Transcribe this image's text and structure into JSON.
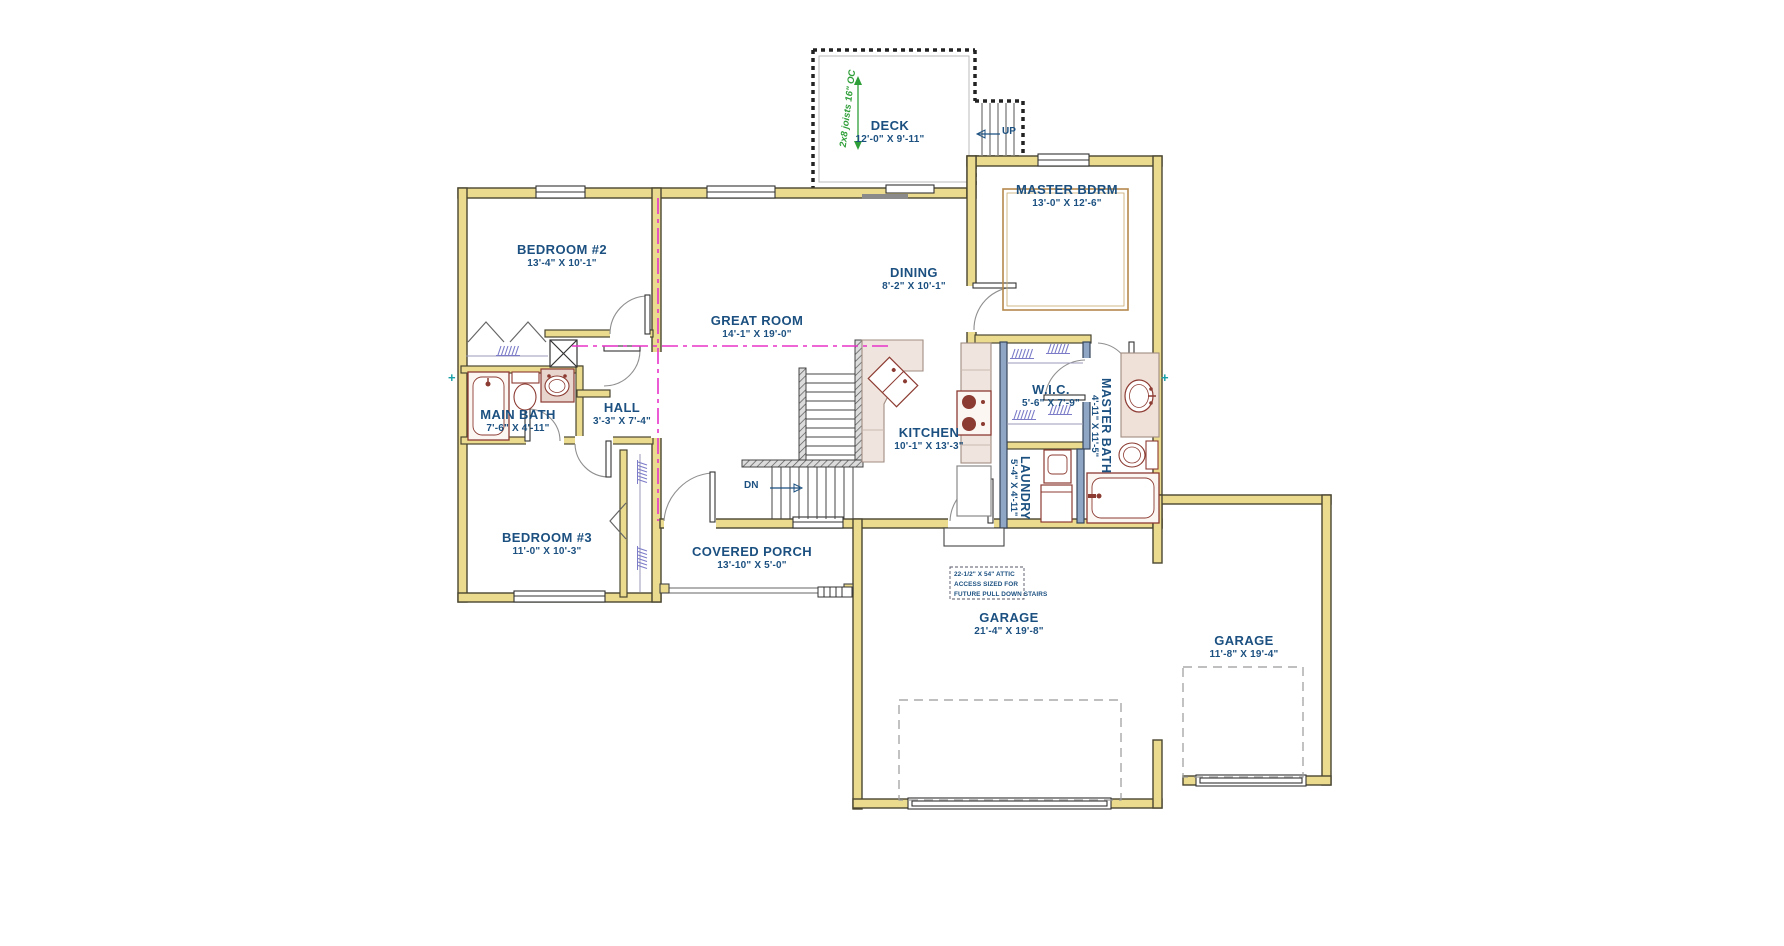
{
  "plan": {
    "title": "First floor residential plan",
    "rooms": [
      {
        "name": "DECK",
        "dims": "12'-0\" X 9'-11\""
      },
      {
        "name": "MASTER BDRM",
        "dims": "13'-0\" X 12'-6\""
      },
      {
        "name": "BEDROOM #2",
        "dims": "13'-4\" X 10'-1\""
      },
      {
        "name": "DINING",
        "dims": "8'-2\" X 10'-1\""
      },
      {
        "name": "GREAT ROOM",
        "dims": "14'-1\" X 19'-0\""
      },
      {
        "name": "MAIN BATH",
        "dims": "7'-6\" X 4'-11\""
      },
      {
        "name": "HALL",
        "dims": "3'-3\" X 7'-4\""
      },
      {
        "name": "KITCHEN",
        "dims": "10'-1\" X 13'-3\""
      },
      {
        "name": "W.I.C.",
        "dims": "5'-6\" X 7'-9\""
      },
      {
        "name": "MASTER BATH",
        "dims": "4'-11\" X 11'-5\""
      },
      {
        "name": "LAUNDRY",
        "dims": "5'-4\" X 4'-11\""
      },
      {
        "name": "BEDROOM #3",
        "dims": "11'-0\" X 10'-3\""
      },
      {
        "name": "COVERED PORCH",
        "dims": "13'-10\" X 5'-0\""
      },
      {
        "name": "GARAGE",
        "dims": "21'-4\" X 19'-8\""
      },
      {
        "name": "GARAGE",
        "dims": "11'-8\" X 19'-4\""
      }
    ],
    "stairs": {
      "up": "UP",
      "down": "DN"
    },
    "notes": {
      "deck_joists": "2x8 joists 16\" OC",
      "attic_line1": "22-1/2\" X 54\" ATTIC",
      "attic_line2": "ACCESS SIZED FOR",
      "attic_line3": "FUTURE PULL DOWN STAIRS"
    },
    "colors": {
      "label_blue": "#1B5080",
      "wall_khaki": "#EADB8F",
      "plumbing_wall_blue": "#8FA6C4",
      "ceiling_break_magenta": "#E833C9",
      "joist_note_green": "#2E9E38",
      "fixture_maroon": "#8C3B32"
    }
  }
}
